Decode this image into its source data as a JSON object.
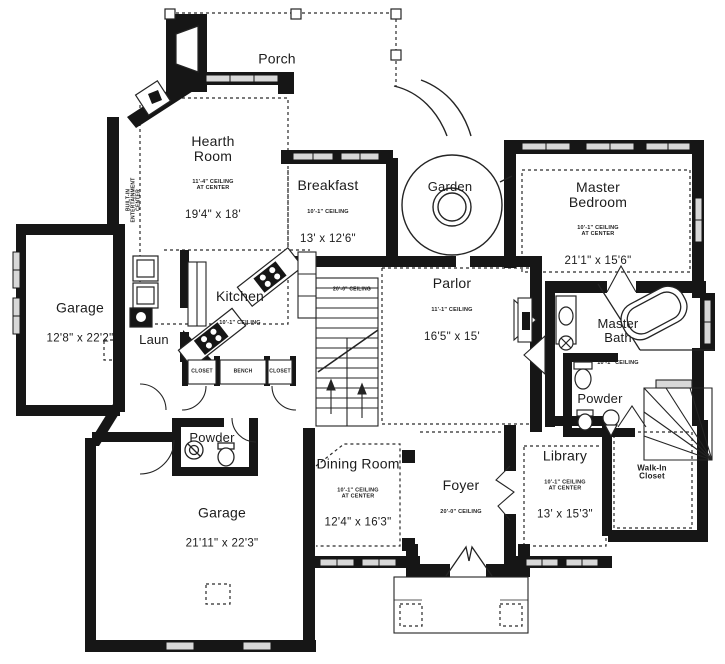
{
  "colors": {
    "wall": "#161616",
    "window_fill": "#d8d8d8",
    "line": "#242424",
    "background": "#ffffff"
  },
  "rooms": {
    "porch": {
      "name": "Porch"
    },
    "hearth": {
      "name": "Hearth\nRoom",
      "ceiling": "11'-4\" CEILING\nAT CENTER",
      "dims": "19'4\" x 18'"
    },
    "breakfast": {
      "name": "Breakfast",
      "ceiling": "10'-1\" CEILING",
      "dims": "13' x 12'6\""
    },
    "garden": {
      "name": "Garden"
    },
    "master_bedroom": {
      "name": "Master\nBedroom",
      "ceiling": "10'-1\" CEILING\nAT CENTER",
      "dims": "21'1\" x 15'6\""
    },
    "garage_left": {
      "name": "Garage",
      "dims": "12'8\" x 22'2\""
    },
    "kitchen": {
      "name": "Kitchen",
      "ceiling": "10'-1\" CEILING"
    },
    "laundry": {
      "name": "Laun"
    },
    "parlor": {
      "name": "Parlor",
      "ceiling": "11'-1\" CEILING",
      "dims": "16'5\" x 15'"
    },
    "master_bath": {
      "name": "Master\nBath",
      "ceiling": "10'-1\" CEILING"
    },
    "powder_right": {
      "name": "Powder"
    },
    "powder_left": {
      "name": "Powder"
    },
    "dining": {
      "name": "Dining Room",
      "ceiling": "10'-1\" CEILING\nAT CENTER",
      "dims": "12'4\" x 16'3\""
    },
    "foyer": {
      "name": "Foyer",
      "ceiling": "20'-0\" CEILING"
    },
    "library": {
      "name": "Library",
      "ceiling": "10'-1\" CEILING\nAT CENTER",
      "dims": "13' x 15'3\""
    },
    "walkin_closet": {
      "name": "Walk-In\nCloset"
    },
    "garage_bottom": {
      "name": "Garage",
      "dims": "21'11\" x 22'3\""
    }
  },
  "annotations": {
    "closet_left": "CLOSET",
    "bench": "BENCH",
    "closet_right": "CLOSET",
    "builtin": "BUILT-IN\nENTERTAINMENT\nCENTER",
    "stair_ceiling": "20'-0\" CEILING"
  }
}
